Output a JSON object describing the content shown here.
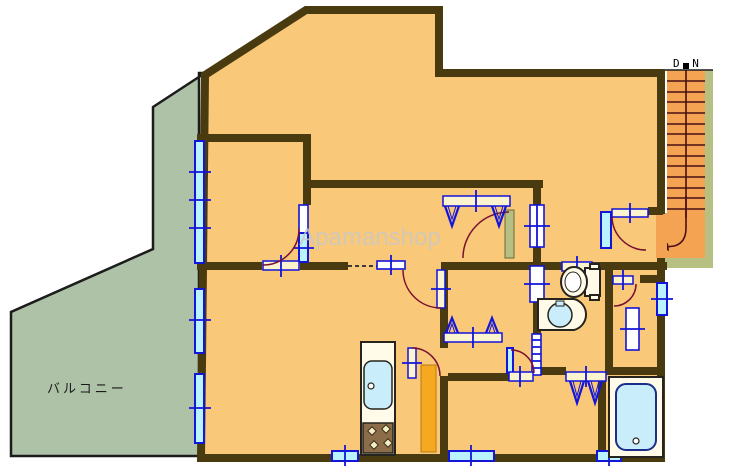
{
  "document": {
    "kind": "apartment-floor-plan"
  },
  "labels": {
    "balcony": "バルコニー",
    "stairs_direction": "D N",
    "watermark": "Apamanshop"
  },
  "colors": {
    "floor": "#f9c879",
    "wall": "#4a3a10",
    "outline": "#1c1c1c",
    "balcony": "#adc2a6",
    "stair": "#f3a352",
    "stairtrim": "#b6c083",
    "tread": "#4b0f14",
    "frame": "#1315d8",
    "glass": "#b9f3ff",
    "leaf": "#fcf3cf",
    "arc": "#7a1030",
    "fixture": "#fffbe8",
    "fixout": "#26241c",
    "water": "#c9edfb",
    "accent": "#f6a821",
    "stove": "#8b6d4a",
    "watermark": "#c8c8c8",
    "dn": "#000000"
  },
  "icons": [
    "staircase-icon",
    "down-arrow-icon",
    "window-icon",
    "door-swing-icon",
    "sliding-door-icon",
    "accordion-door-icon",
    "closet-hanger-icon",
    "toilet-icon",
    "washbasin-icon",
    "bathtub-icon",
    "kitchen-sink-icon",
    "gas-stove-icon"
  ]
}
